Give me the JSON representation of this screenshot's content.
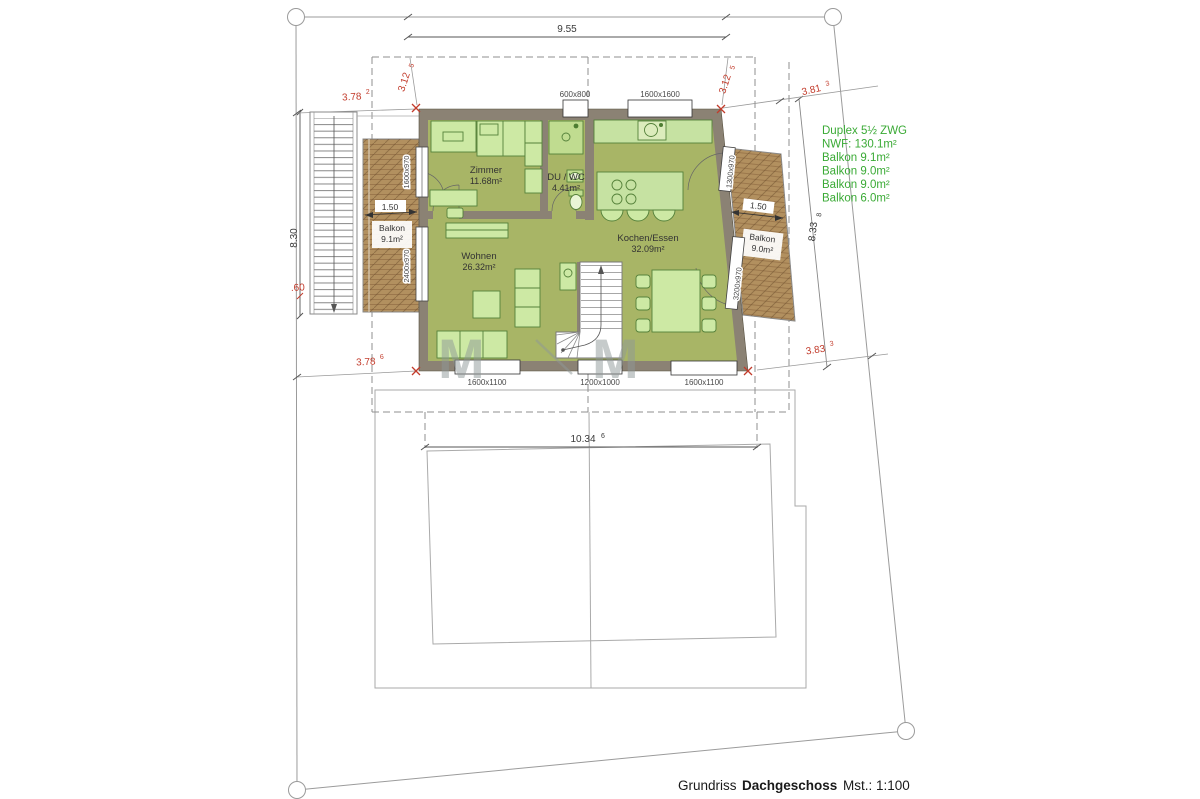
{
  "title": {
    "prefix": "Grundriss",
    "floor": "Dachgeschoss",
    "scale": "Mst.: 1:100"
  },
  "legend": {
    "color": "#3aaa35",
    "lines": [
      "Duplex 5½ ZWG",
      "NWF: 130.1m²",
      "Balkon 9.1m²",
      "Balkon 9.0m²",
      "Balkon 9.0m²",
      "Balkon 6.0m²"
    ]
  },
  "rooms": {
    "zimmer": {
      "name": "Zimmer",
      "area": "11.68m²"
    },
    "duwc": {
      "name": "DU / WC",
      "area": "4.41m²"
    },
    "kochen": {
      "name": "Kochen/Essen",
      "area": "32.09m²"
    },
    "wohnen": {
      "name": "Wohnen",
      "area": "26.32m²"
    },
    "balkon_left": {
      "name": "Balkon",
      "area": "9.1m²"
    },
    "balkon_right": {
      "name": "Balkon",
      "area": "9.0m²"
    }
  },
  "dimensions": {
    "top_width": "9.55",
    "stair_height": "8.30",
    "stair_offset": ".60",
    "lower_width": "10.34",
    "lower_width_sup": "6",
    "right_depth": "8.33",
    "right_depth_sup": "8",
    "balkon_left_depth": "1.50",
    "balkon_right_depth": "1.50",
    "red": {
      "left_top": {
        "v": "3.78",
        "sup": "2"
      },
      "roof_left": {
        "v": "3.12",
        "sup": "5"
      },
      "roof_right": {
        "v": "3.12",
        "sup": "5"
      },
      "right_top": {
        "v": "3.81",
        "sup": "3"
      },
      "left_bottom": {
        "v": "3.78",
        "sup": "6"
      },
      "right_bottom": {
        "v": "3.83",
        "sup": "3"
      }
    }
  },
  "windows": {
    "top_small": "600x800",
    "top_large": "1600x1600",
    "bottom_left": "1600x1100",
    "bottom_mid": "1200x1000",
    "bottom_right": "1600x1100",
    "left_upper": "1600x970",
    "left_lower": "2400x970",
    "right_upper": "1300x970",
    "right_lower": "3200x970"
  },
  "watermark": {
    "letter": "M"
  }
}
